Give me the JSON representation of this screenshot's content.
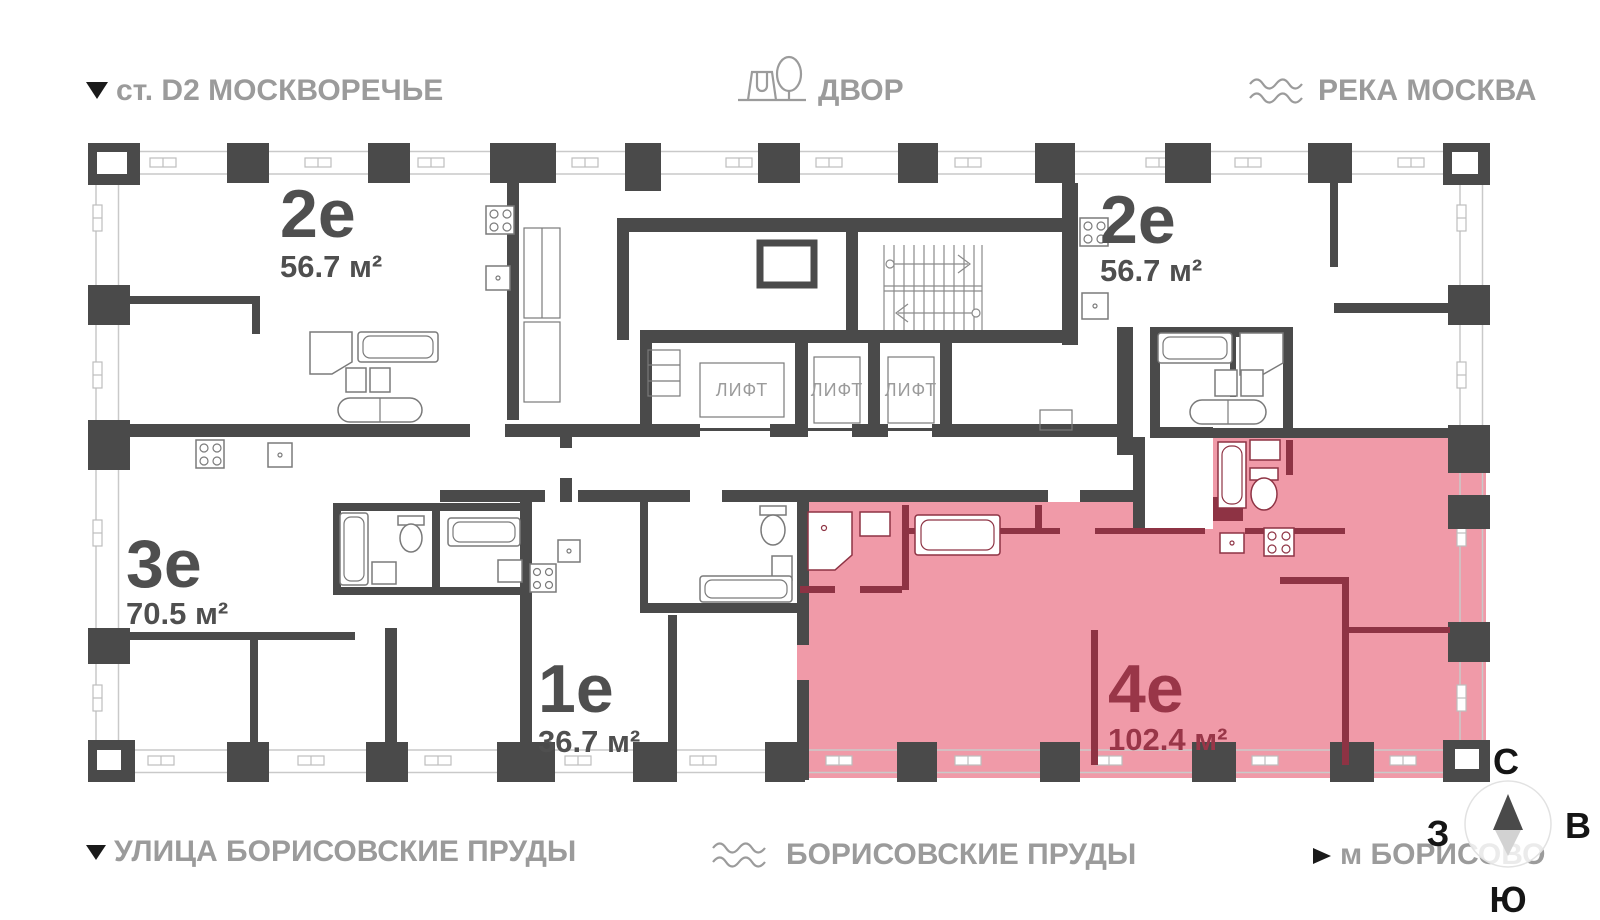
{
  "landmarks": {
    "station": "ст. D2 МОСКВОРЕЧЬЕ",
    "courtyard": "ДВОР",
    "river": "РЕКА МОСКВА",
    "street": "УЛИЦА БОРИСОВСКИЕ ПРУДЫ",
    "ponds": "БОРИСОВСКИЕ ПРУДЫ",
    "metro": "м БОРИСОВО"
  },
  "apartments": {
    "a2e_left": {
      "type": "2е",
      "area": "56.7 м²"
    },
    "a2e_right": {
      "type": "2е",
      "area": "56.7 м²"
    },
    "a3e": {
      "type": "3е",
      "area": "70.5 м²"
    },
    "a1e": {
      "type": "1е",
      "area": "36.7 м²"
    },
    "a4e": {
      "type": "4е",
      "area": "102.4 м²",
      "highlighted": "true"
    }
  },
  "elevators": {
    "lift1": "ЛИФТ",
    "lift2": "ЛИФТ",
    "lift3": "ЛИФТ"
  },
  "compass": {
    "north": "С",
    "east": "В",
    "south": "Ю",
    "west": "З"
  },
  "colors": {
    "wall": "#4a4a4a",
    "highlight_fill": "#f09aa8",
    "highlight_wall": "#8e3344",
    "label_gray": "#9b9b9b",
    "label_dark": "#4f4f4f",
    "highlight_label": "#993648"
  }
}
